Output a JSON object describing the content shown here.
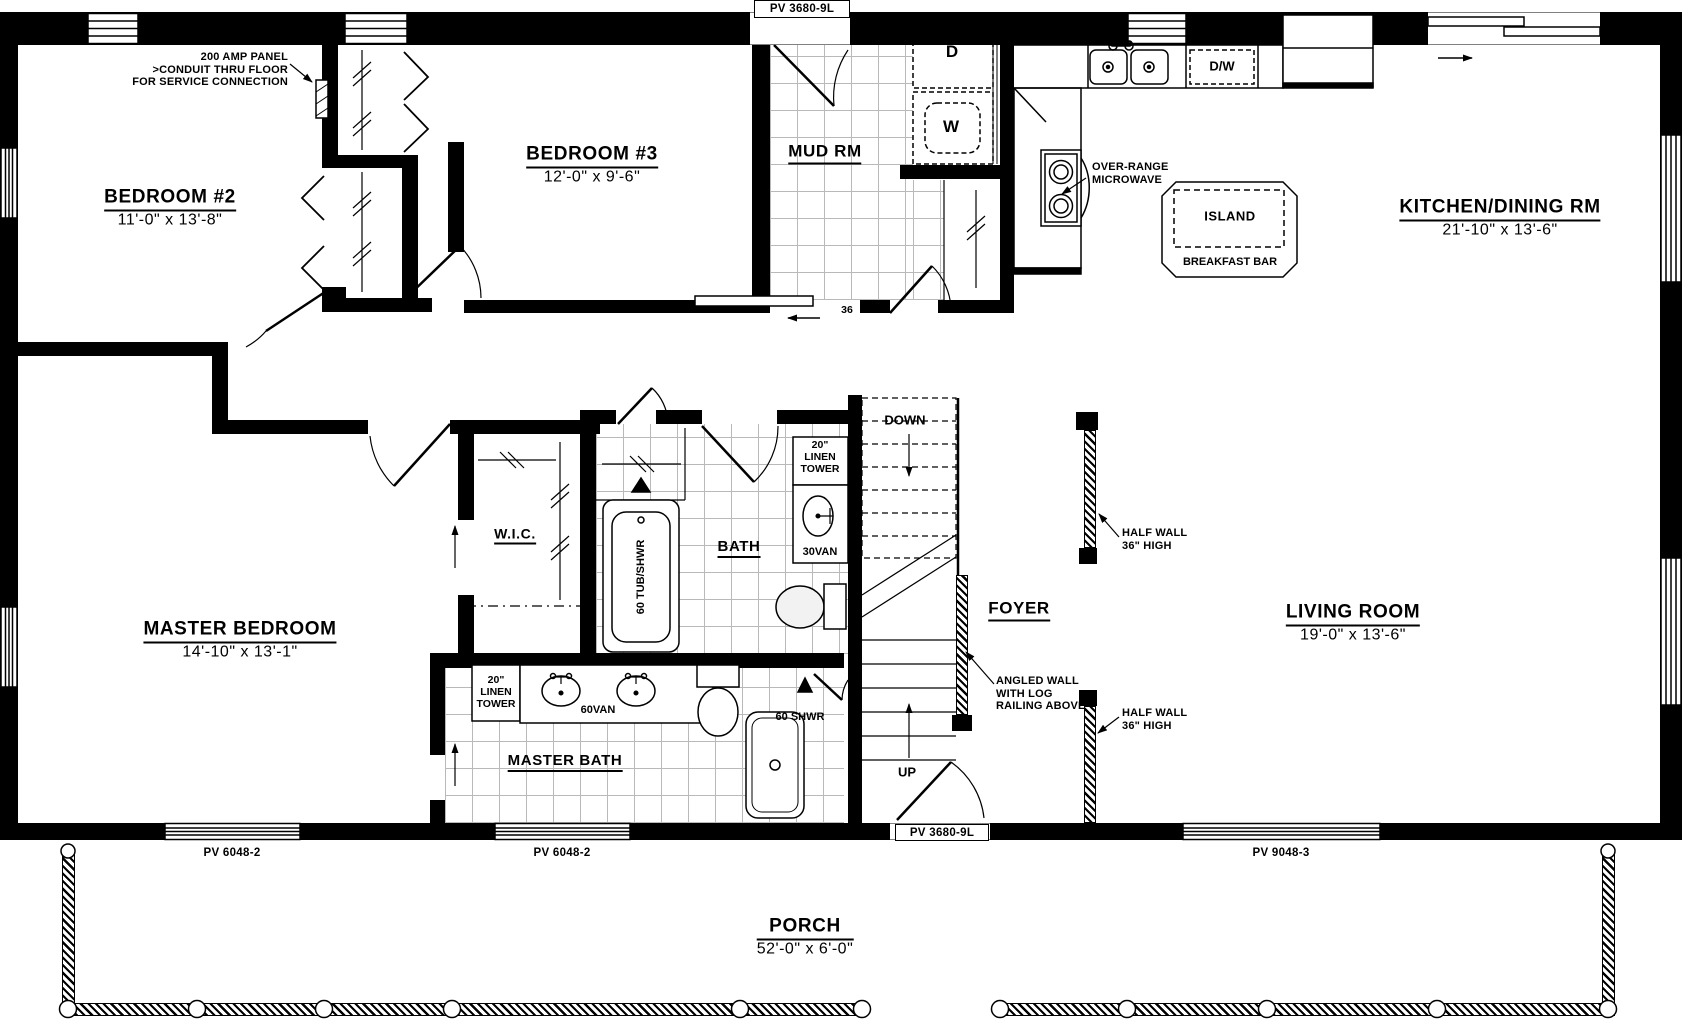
{
  "rooms": {
    "bedroom2": {
      "name": "BEDROOM #2",
      "dims": "11'-0\" x 13'-8\""
    },
    "bedroom3": {
      "name": "BEDROOM #3",
      "dims": "12'-0\" x 9'-6\""
    },
    "mudroom": {
      "name": "MUD RM"
    },
    "kitchen": {
      "name": "KITCHEN/DINING RM",
      "dims": "21'-10\" x 13'-6\""
    },
    "master_bedroom": {
      "name": "MASTER BEDROOM",
      "dims": "14'-10\" x 13'-1\""
    },
    "wic": {
      "name": "W.I.C."
    },
    "bath": {
      "name": "BATH"
    },
    "foyer": {
      "name": "FOYER"
    },
    "living_room": {
      "name": "LIVING ROOM",
      "dims": "19'-0\" x 13'-6\""
    },
    "master_bath": {
      "name": "MASTER BATH"
    },
    "porch": {
      "name": "PORCH",
      "dims": "52'-0\" x 6'-0\""
    }
  },
  "annotations": {
    "amp_panel": {
      "line1": "200 AMP PANEL",
      "line2": ">CONDUIT THRU FLOOR",
      "line3": "FOR SERVICE CONNECTION"
    },
    "microwave": {
      "line1": "OVER-RANGE",
      "line2": "MICROWAVE"
    },
    "half_wall_upper": {
      "line1": "HALF WALL",
      "line2": "36\" HIGH"
    },
    "half_wall_lower": {
      "line1": "HALF WALL",
      "line2": "36\" HIGH"
    },
    "angled_wall": {
      "line1": "ANGLED WALL",
      "line2": "WITH LOG",
      "line3": "RAILING ABOVE"
    },
    "down": "DOWN",
    "up": "UP",
    "door_width": "36"
  },
  "fixtures": {
    "dryer": "D",
    "washer": "W",
    "dishwasher": "D/W",
    "island": "ISLAND",
    "breakfast_bar": "BREAKFAST BAR",
    "linen_tower_bath": {
      "line1": "20\"",
      "line2": "LINEN",
      "line3": "TOWER"
    },
    "linen_tower_master": {
      "line1": "20\"",
      "line2": "LINEN",
      "line3": "TOWER"
    },
    "vanity30": "30VAN",
    "vanity60": "60VAN",
    "tub": "60 TUB/SHWR",
    "shower": "60 SHWR"
  },
  "openings": {
    "door_top": "PV 3680-9L",
    "window_bottom_left1": "PV 6048-2",
    "window_bottom_left2": "PV 6048-2",
    "door_front": "PV 3680-9L",
    "window_bottom_right": "PV 9048-3"
  },
  "colors": {
    "line": "#000000",
    "tile": "#b9b9b9"
  }
}
